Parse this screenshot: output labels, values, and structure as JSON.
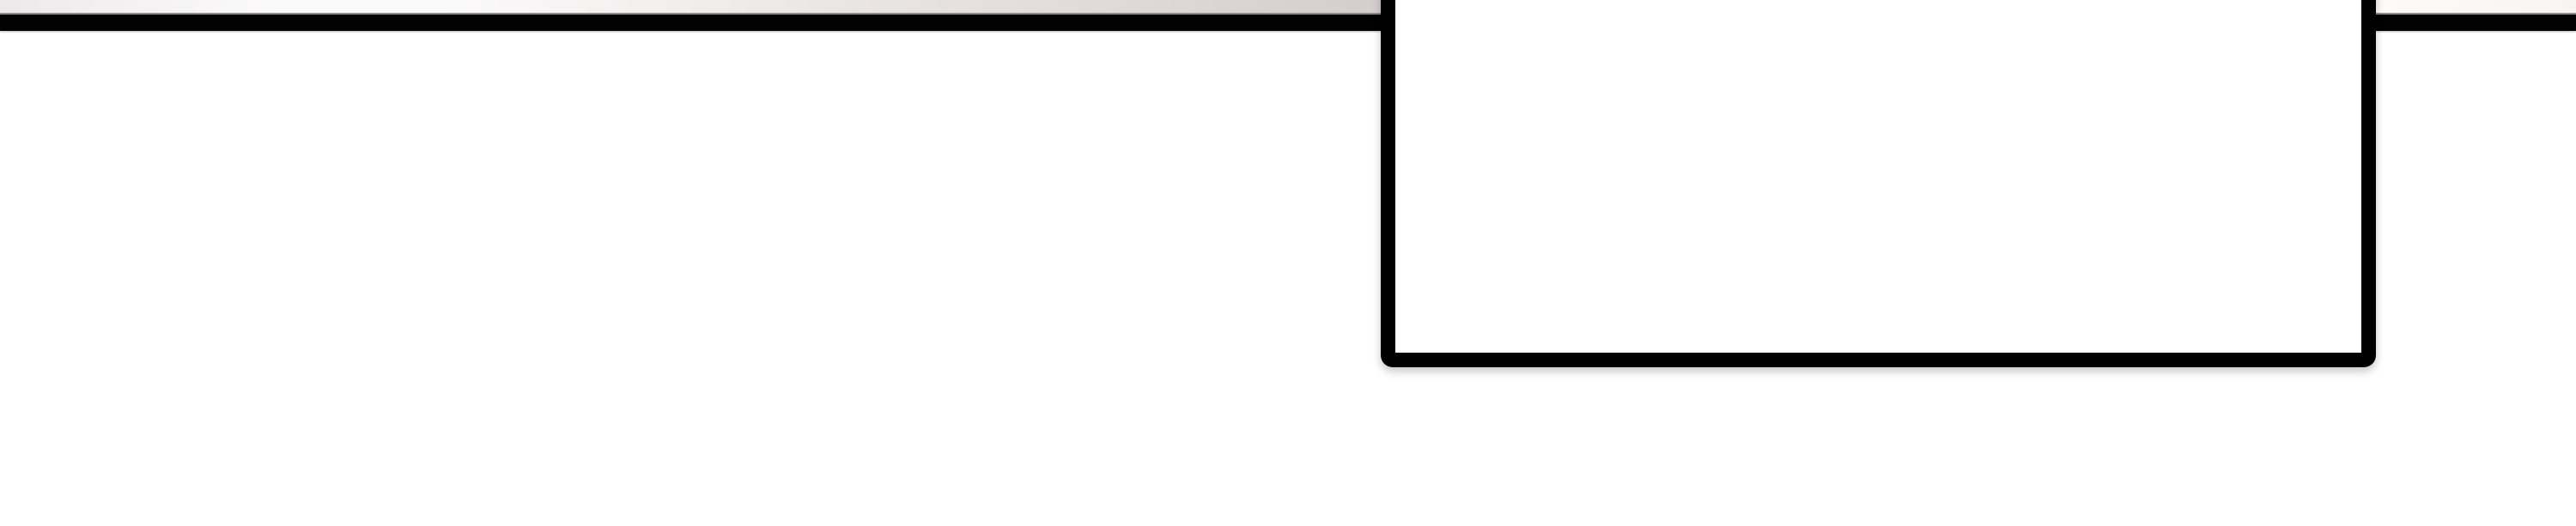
{
  "window": {
    "background_color": "#ffffff"
  },
  "top_edge_strip": {
    "left_color_start": "#ece9ea",
    "left_color_light": "#fbfafa",
    "left_color_mid": "#eae5e5",
    "left_color_end": "#d4cdcd",
    "right_color_start": "#fcfbfa",
    "right_color_end": "#f7f5f3"
  },
  "menu_bar": {
    "background_color": "#020202",
    "top_edge_highlight_color": "#8b8887"
  },
  "popup_panel": {
    "background_color": "#ffffff",
    "border_color": "#000000"
  }
}
